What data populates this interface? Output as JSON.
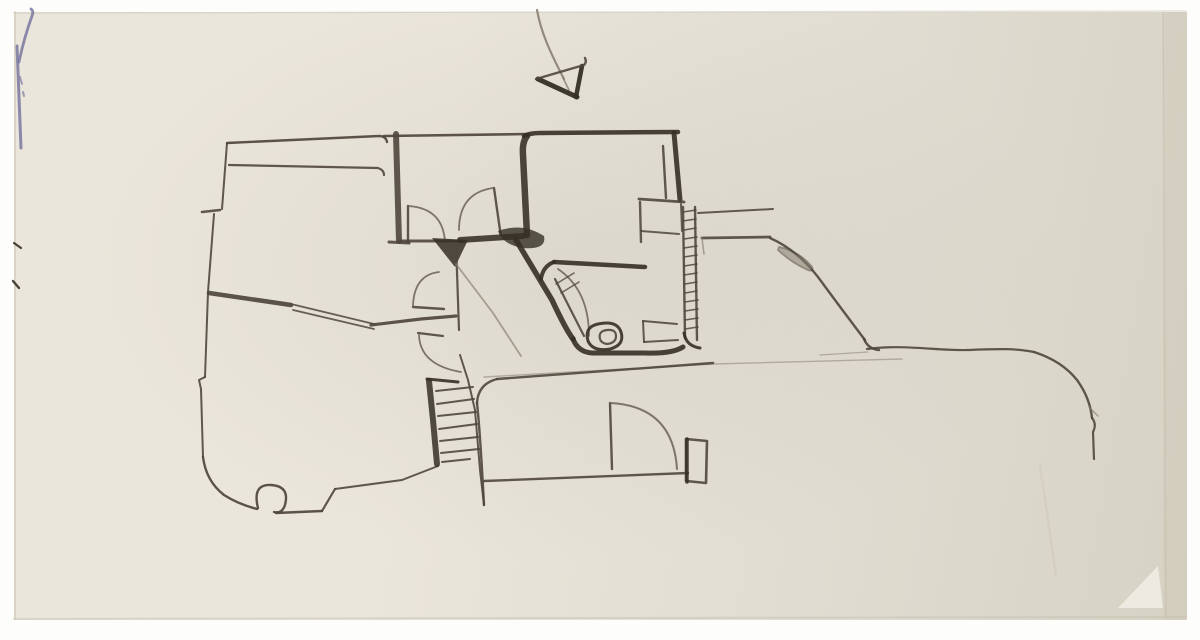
{
  "meta": {
    "description": "Photograph of a freehand architectural floor-plan sketch drawn in ink on an off-white sheet of paper. A north/direction arrow sits above the plan. The plan contains an organic-shaped left room, an upper-middle room, a square kitchen-like room with heavy walls, a small bathroom with toilet and sink, a hatched wall, a staircase, several swing doors, a lower room, and a long curved terrace edge to the right. A small blue pen mark sits at the top-left paper edge.",
    "media": "ink and pencil on paper",
    "elements": [
      "north-arrow",
      "left-room",
      "upper-middle-room",
      "kitchen-room",
      "bathroom",
      "toilet",
      "sink",
      "hatched-wall",
      "staircase",
      "swing-doors",
      "lower-room",
      "terrace-edge",
      "blue-pen-mark",
      "paper-fold"
    ]
  },
  "sketch": {
    "colors": {
      "paper1": "#ebe6db",
      "paper2": "#e0dcd1",
      "paper3": "#d6d2c4",
      "inkDark": "#352f26",
      "ink": "#4f473c",
      "inkMid": "#6a6155",
      "inkLight": "#8a8173",
      "pencil": "#a59d8f",
      "blue": "#7a78a0",
      "shadow": "#c6bfb0",
      "curl": "#f3f0e8",
      "band": "#cdc5b5"
    },
    "strokes": [
      {
        "n": "paper-right-band",
        "d": "M1163,12 L1187,12 L1187,620 L1163,620 Z",
        "w": 0,
        "f": "band",
        "o": 0.35
      },
      {
        "n": "paper-right-edge-line",
        "d": "M1163,14 L1166,618",
        "w": 1.5,
        "c": "shadow",
        "o": 0.6
      },
      {
        "n": "paper-top-edge",
        "d": "M14,13 L1186,11",
        "w": 1.5,
        "c": "shadow",
        "o": 0.45
      },
      {
        "n": "paper-bottom-edge",
        "d": "M14,619 L1186,617",
        "w": 2,
        "c": "shadow",
        "o": 0.5
      },
      {
        "n": "paper-left-edge",
        "d": "M15,12 L15,619",
        "w": 2,
        "c": "shadow",
        "o": 0.45
      },
      {
        "n": "paper-crease",
        "d": "M1040,465 L1056,575",
        "w": 2.5,
        "c": "shadow",
        "o": 0.3
      },
      {
        "n": "paper-corner-curl",
        "d": "M1118,608 L1158,566 L1163,608 Z",
        "w": 0,
        "f": "curl",
        "o": 0.8
      },
      {
        "n": "blue-pen-mark-vertical",
        "d": "M17,46 Q19,95 21,148",
        "w": 3,
        "c": "blue",
        "o": 0.85
      },
      {
        "n": "blue-pen-mark-branch",
        "d": "M19,62 Q24,38 32,16 Q34,11 31,9",
        "w": 2.8,
        "c": "blue",
        "o": 0.85
      },
      {
        "n": "blue-pen-mark-dots",
        "d": "M20,77 L22,84 M23,92 L24,96",
        "w": 2,
        "c": "blue",
        "o": 0.7
      },
      {
        "n": "left-edge-tick-1",
        "d": "M14,243 L21,248",
        "w": 2.2,
        "c": "inkDark",
        "o": 0.9
      },
      {
        "n": "left-edge-tick-2",
        "d": "M13,281 L19,288",
        "w": 2.4,
        "c": "inkDark",
        "o": 0.9
      },
      {
        "n": "north-arrow-stem",
        "d": "M537,10 C541,32 549,50 564,79",
        "w": 2.2,
        "c": "inkLight",
        "o": 0.9
      },
      {
        "n": "north-arrow-stem-tail",
        "d": "M563,78 L569,90",
        "w": 1.8,
        "c": "inkLight",
        "o": 0.8
      },
      {
        "n": "north-arrow-left-edge",
        "d": "M538,79 L577,97",
        "w": 5,
        "c": "inkDark",
        "o": 0.95
      },
      {
        "n": "north-arrow-right-edge",
        "d": "M582,66 L576,97",
        "w": 4.5,
        "c": "inkDark",
        "o": 0.95
      },
      {
        "n": "north-arrow-top-edge",
        "d": "M536,79 L584,65 Q587,62 585,58",
        "w": 2.4,
        "c": "ink",
        "o": 0.9
      },
      {
        "n": "left-room-top-wall-outer",
        "d": "M227,143 L379,136 Q386,136 387,142",
        "w": 2.4,
        "c": "ink",
        "o": 0.92
      },
      {
        "n": "left-room-top-wall-inner",
        "d": "M229,165 L378,168 Q384,170 384,175",
        "w": 2.2,
        "c": "ink",
        "o": 0.9
      },
      {
        "n": "left-room-left-wall-upper",
        "d": "M227,143 L222,209",
        "w": 2,
        "c": "ink",
        "o": 0.9
      },
      {
        "n": "left-room-window-tick",
        "d": "M202,212 L220,210",
        "w": 2.6,
        "c": "ink",
        "o": 0.9
      },
      {
        "n": "left-room-left-wall-mid",
        "d": "M214,214 L208,292 L205,377",
        "w": 2,
        "c": "ink",
        "o": 0.9
      },
      {
        "n": "left-room-left-wall-jog",
        "d": "M205,377 L199,380 L201,389 L203,457",
        "w": 2,
        "c": "ink",
        "o": 0.9
      },
      {
        "n": "left-room-bottom-curve",
        "d": "M203,457 Q206,481 224,495 Q238,504 257,509",
        "w": 2.4,
        "c": "ink",
        "o": 0.92
      },
      {
        "n": "left-room-column-loop",
        "d": "M258,508 Q252,484 271,485 Q290,486 285,505 Q282,514 274,512",
        "w": 2.4,
        "c": "ink",
        "o": 0.92
      },
      {
        "n": "left-room-bottom-wall",
        "d": "M276,513 L322,511",
        "w": 2.4,
        "c": "ink",
        "o": 0.92
      },
      {
        "n": "left-room-bottom-step",
        "d": "M322,511 L335,489",
        "w": 2.2,
        "c": "ink",
        "o": 0.9
      },
      {
        "n": "left-room-bottom-wall-2",
        "d": "M335,489 L402,480 L438,466",
        "w": 2,
        "c": "ink",
        "o": 0.9
      },
      {
        "n": "left-room-interior-wall-thick",
        "d": "M209,293 L291,305",
        "w": 4.5,
        "c": "ink",
        "o": 0.92
      },
      {
        "n": "left-room-interior-double-a",
        "d": "M291,304 L374,324",
        "w": 1.8,
        "c": "ink",
        "o": 0.85
      },
      {
        "n": "left-room-interior-double-b",
        "d": "M293,310 L374,329",
        "w": 1.8,
        "c": "ink",
        "o": 0.85
      },
      {
        "n": "left-room-interior-wall-thick-2",
        "d": "M371,325 L421,319 L456,316",
        "w": 3.2,
        "c": "ink",
        "o": 0.92
      },
      {
        "n": "upper-room-top-wall",
        "d": "M384,136 L528,134",
        "w": 2.6,
        "c": "ink",
        "o": 0.92
      },
      {
        "n": "upper-room-left-wall",
        "d": "M396,134 L399,241",
        "w": 6,
        "c": "ink",
        "o": 0.9
      },
      {
        "n": "upper-room-left-wall-cap",
        "d": "M389,242 L409,243",
        "w": 3,
        "c": "ink",
        "o": 0.9
      },
      {
        "n": "upper-room-bottom-wall",
        "d": "M399,241 L462,241",
        "w": 3,
        "c": "ink",
        "o": 0.9
      },
      {
        "n": "upper-room-bottom-wall-heavy",
        "d": "M460,240 L523,236",
        "w": 6,
        "c": "inkDark",
        "o": 0.88
      },
      {
        "n": "door-1-leaf",
        "d": "M408,206 L408,242",
        "w": 2.4,
        "c": "ink",
        "o": 0.9
      },
      {
        "n": "door-1-swing-arc",
        "d": "M408,206 Q443,208 445,242",
        "w": 1.8,
        "c": "inkMid",
        "o": 0.85
      },
      {
        "n": "door-2-leaf",
        "d": "M494,188 L501,237",
        "w": 2.4,
        "c": "ink",
        "o": 0.9
      },
      {
        "n": "door-2-swing-arc",
        "d": "M493,188 Q459,193 459,230",
        "w": 1.8,
        "c": "inkMid",
        "o": 0.85
      },
      {
        "n": "kitchen-top-wall",
        "d": "M524,136 Q530,133 540,133 L678,132",
        "w": 4.5,
        "c": "inkDark",
        "o": 0.9
      },
      {
        "n": "kitchen-left-wall",
        "d": "M527,136 Q522,142 523,155 L527,235",
        "w": 6.5,
        "c": "inkDark",
        "o": 0.88
      },
      {
        "n": "kitchen-right-wall",
        "d": "M674,133 L680,200",
        "w": 5,
        "c": "inkDark",
        "o": 0.9
      },
      {
        "n": "kitchen-inner-right",
        "d": "M663,146 L666,198",
        "w": 2.4,
        "c": "ink",
        "o": 0.9
      },
      {
        "n": "kitchen-inner-bottom",
        "d": "M639,199 L684,202",
        "w": 2.8,
        "c": "ink",
        "o": 0.9
      },
      {
        "n": "alcove-left-wall",
        "d": "M640,202 L641,242",
        "w": 2.4,
        "c": "ink",
        "o": 0.88
      },
      {
        "n": "alcove-bottom",
        "d": "M641,231 L679,234",
        "w": 2,
        "c": "ink",
        "o": 0.85
      },
      {
        "n": "alcove-right-wall",
        "d": "M681,204 L682,231",
        "w": 2,
        "c": "ink",
        "o": 0.85
      },
      {
        "n": "junction-poche-triangle",
        "d": "M432,238 L468,240 L455,267 Z",
        "w": 0,
        "f": "inkDark",
        "o": 0.85
      },
      {
        "n": "junction-vertical-wall",
        "d": "M456,243 L459,330",
        "w": 2.2,
        "c": "ink",
        "o": 0.9
      },
      {
        "n": "kitchen-wall-foot-blob",
        "d": "M498,231 Q522,222 544,236 Q547,250 523,248 Q503,245 498,231 Z",
        "w": 0,
        "f": "inkDark",
        "o": 0.8
      },
      {
        "n": "corridor-faint-diagonal",
        "d": "M456,264 L493,313 L521,356",
        "w": 1.8,
        "c": "inkLight",
        "o": 0.7
      },
      {
        "n": "door-3-leaf",
        "d": "M413,307 L444,309",
        "w": 2.4,
        "c": "ink",
        "o": 0.9
      },
      {
        "n": "door-3-swing-arc",
        "d": "M413,306 Q414,275 439,272",
        "w": 1.8,
        "c": "inkMid",
        "o": 0.85
      },
      {
        "n": "bathroom-left-wall-diagonal",
        "d": "M516,240 L552,300 Q566,330 573,339",
        "w": 5.5,
        "c": "inkDark",
        "o": 0.9
      },
      {
        "n": "bathroom-bottom-wall",
        "d": "M573,339 Q578,352 592,353 L645,353 Q672,354 683,347",
        "w": 5,
        "c": "inkDark",
        "o": 0.9
      },
      {
        "n": "bathroom-top-wall",
        "d": "M554,262 L645,267",
        "w": 4.5,
        "c": "inkDark",
        "o": 0.9
      },
      {
        "n": "bathroom-top-corner",
        "d": "M554,262 Q543,266 541,279",
        "w": 4,
        "c": "inkDark",
        "o": 0.9
      },
      {
        "n": "bathroom-door-leaf",
        "d": "M555,279 L584,336",
        "w": 2.2,
        "c": "ink",
        "o": 0.9
      },
      {
        "n": "bathroom-door-swing-arc",
        "d": "M558,269 Q589,290 589,336",
        "w": 1.8,
        "c": "inkMid",
        "o": 0.85
      },
      {
        "n": "bathroom-door-tick-1",
        "d": "M556,284 L574,273",
        "w": 1.5,
        "c": "ink",
        "o": 0.8
      },
      {
        "n": "bathroom-door-tick-2",
        "d": "M561,293 L579,282",
        "w": 1.5,
        "c": "ink",
        "o": 0.8
      },
      {
        "n": "toilet-bowl-outer",
        "d": "M588,341 Q584,327 598,324 Q617,320 621,332 Q625,345 610,349 Q593,352 588,341 Z",
        "w": 3,
        "c": "inkDark",
        "o": 0.9
      },
      {
        "n": "toilet-bowl-inner",
        "d": "M600,339 Q598,331 607,330 Q616,329 616,336 Q616,343 607,344 Q601,343 600,339 Z",
        "w": 2.2,
        "c": "ink",
        "o": 0.9
      },
      {
        "n": "sink-top",
        "d": "M643,321 L677,324",
        "w": 2,
        "c": "ink",
        "o": 0.88
      },
      {
        "n": "sink-left",
        "d": "M643,321 L644,342",
        "w": 2,
        "c": "ink",
        "o": 0.88
      },
      {
        "n": "sink-bottom",
        "d": "M644,342 L678,340",
        "w": 2,
        "c": "ink",
        "o": 0.88
      },
      {
        "n": "hatched-wall-left-line",
        "d": "M683,207 L685,338",
        "w": 2.4,
        "c": "ink",
        "o": 0.9
      },
      {
        "n": "hatched-wall-right-line",
        "d": "M695,207 L697,340",
        "w": 2.4,
        "c": "ink",
        "o": 0.9
      },
      {
        "n": "hatched-wall-rungs",
        "d": "M683,212 L696,210 M683,221 L696,219 M684,230 L696,228 M684,239 L697,237 M684,248 L697,246 M684,257 L697,255 M684,266 L697,264 M684,275 L697,273 M685,284 L697,282 M685,293 L697,291 M685,302 L698,300 M685,311 L698,309 M685,320 L698,318 M685,329 L698,327",
        "w": 1.6,
        "c": "ink",
        "o": 0.85
      },
      {
        "n": "hatched-wall-bottom-curve",
        "d": "M684,333 Q686,346 700,348",
        "w": 3,
        "c": "inkDark",
        "o": 0.9
      },
      {
        "n": "right-wing-top-line",
        "d": "M698,213 L773,209",
        "w": 2,
        "c": "ink",
        "o": 0.88
      },
      {
        "n": "right-wing-mid-line",
        "d": "M702,238 L770,237",
        "w": 2.8,
        "c": "ink",
        "o": 0.9
      },
      {
        "n": "right-wing-mid-hook",
        "d": "M702,238 L704,254",
        "w": 1.5,
        "c": "inkLight",
        "o": 0.7
      },
      {
        "n": "right-wing-diagonal-wall",
        "d": "M770,238 Q797,250 818,277 Q843,311 865,340",
        "w": 2.4,
        "c": "ink",
        "o": 0.9
      },
      {
        "n": "right-wing-door-pod",
        "d": "M779,247 Q799,251 812,267 Q814,272 808,270 Q792,263 778,250 Z",
        "w": 1.8,
        "c": "ink",
        "f": "inkLight",
        "o": 0.55
      },
      {
        "n": "right-wing-diagonal-hook",
        "d": "M864,339 Q868,349 879,350",
        "w": 2.4,
        "c": "ink",
        "o": 0.9
      },
      {
        "n": "terrace-edge-line",
        "d": "M867,349 C900,344 940,351 968,350 C995,349 1015,348 1034,352",
        "w": 2.2,
        "c": "ink",
        "o": 0.9
      },
      {
        "n": "terrace-edge-curve",
        "d": "M1034,352 Q1062,361 1077,380 Q1090,398 1092,418",
        "w": 2.4,
        "c": "ink",
        "o": 0.9
      },
      {
        "n": "terrace-edge-end",
        "d": "M1092,418 Q1097,424 1093,432 L1094,459",
        "w": 2.2,
        "c": "ink",
        "o": 0.9
      },
      {
        "n": "terrace-edge-kink",
        "d": "M1089,407 L1098,416",
        "w": 1.5,
        "c": "inkLight",
        "o": 0.7
      },
      {
        "n": "pencil-guideline-right",
        "d": "M820,355 L868,352",
        "w": 1.2,
        "c": "pencil",
        "o": 0.8
      },
      {
        "n": "pencil-guideline-long",
        "d": "M484,377 L713,364 L902,359",
        "w": 1.4,
        "c": "pencil",
        "o": 0.8
      },
      {
        "n": "lower-room-top-corner",
        "d": "M477,403 Q478,384 497,379",
        "w": 2.4,
        "c": "ink",
        "o": 0.9
      },
      {
        "n": "lower-room-top-wall",
        "d": "M497,379 L713,363",
        "w": 2.4,
        "c": "ink",
        "o": 0.9
      },
      {
        "n": "lower-room-left-wall",
        "d": "M477,403 Q480,430 484,505",
        "w": 2.4,
        "c": "ink",
        "o": 0.9
      },
      {
        "n": "lower-room-bottom-wall",
        "d": "M484,481 L688,473",
        "w": 2.4,
        "c": "ink",
        "o": 0.9
      },
      {
        "n": "door-5-leaf",
        "d": "M610,403 L612,469",
        "w": 2.4,
        "c": "ink",
        "o": 0.9
      },
      {
        "n": "door-5-swing-arc",
        "d": "M610,403 Q673,406 677,469",
        "w": 2,
        "c": "inkMid",
        "o": 0.85
      },
      {
        "n": "door-jamb-rect",
        "d": "M686,439 L707,441 L706,483 L686,481 Z",
        "w": 2.6,
        "c": "ink",
        "o": 0.9
      },
      {
        "n": "door-jamb-heavy-edge",
        "d": "M687,439 L687,482",
        "w": 3.5,
        "c": "inkDark",
        "o": 0.88
      },
      {
        "n": "stair-landing-edge",
        "d": "M427,379 L458,382",
        "w": 3,
        "c": "inkDark",
        "o": 0.9
      },
      {
        "n": "stair-left-rail",
        "d": "M429,381 L433,420 L437,464",
        "w": 6,
        "c": "inkDark",
        "o": 0.85
      },
      {
        "n": "stair-treads",
        "d": "M436,391 L473,387 M437,404 L474,399 M438,416 L476,412 M439,429 L477,424 M440,441 L478,437 M441,453 L479,449 M442,462 L470,459",
        "w": 2,
        "c": "ink",
        "o": 0.9
      },
      {
        "n": "stair-right-rail",
        "d": "M460,355 L468,380 L475,410 L480,470 L484,505",
        "w": 2,
        "c": "ink",
        "o": 0.9
      },
      {
        "n": "door-4-leaf",
        "d": "M418,333 L443,336",
        "w": 2.2,
        "c": "ink",
        "o": 0.9
      },
      {
        "n": "door-4-swing-arc",
        "d": "M419,335 Q420,365 461,372",
        "w": 1.8,
        "c": "inkMid",
        "o": 0.85
      }
    ]
  }
}
